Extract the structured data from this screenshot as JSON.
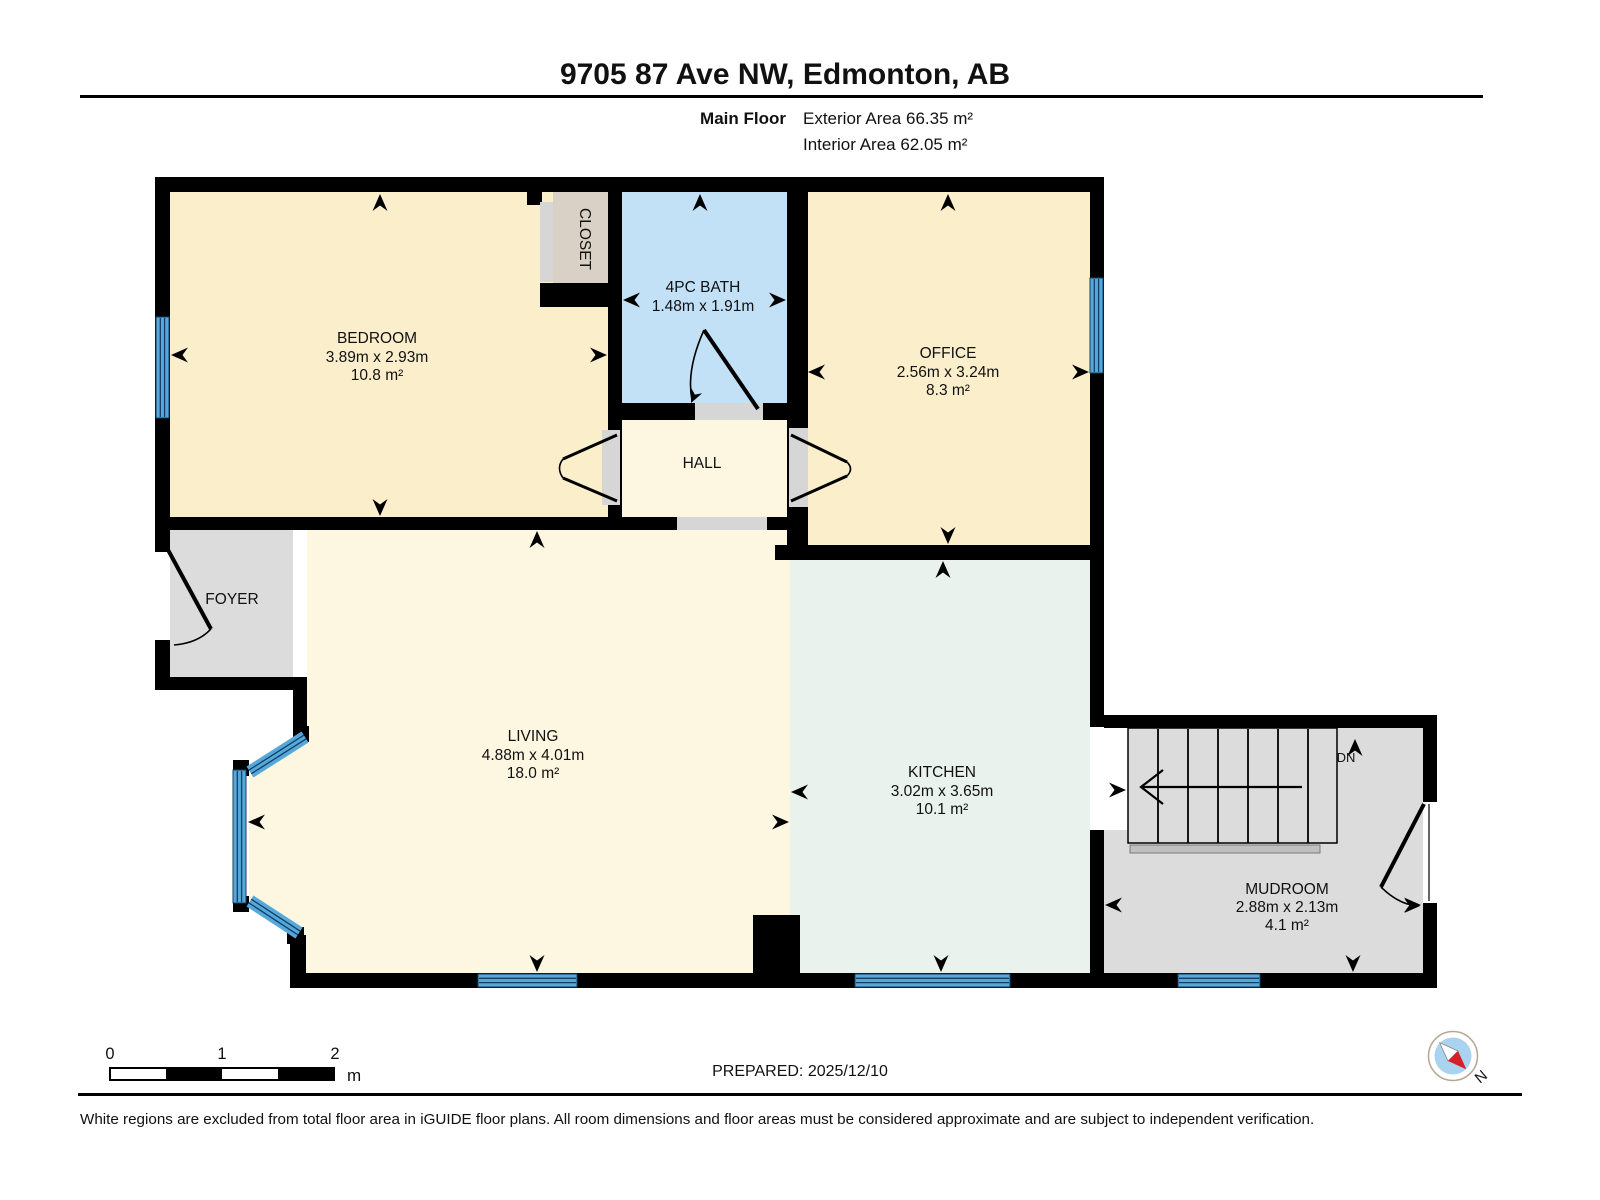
{
  "header": {
    "title": "9705 87 Ave NW, Edmonton, AB",
    "floor_label": "Main Floor",
    "exterior_area": "Exterior Area 66.35 m²",
    "interior_area": "Interior Area 62.05 m²"
  },
  "rooms": {
    "bedroom": {
      "name": "BEDROOM",
      "dims": "3.89m x 2.93m",
      "area": "10.8 m²"
    },
    "closet": {
      "name": "CLOSET"
    },
    "bath": {
      "name": "4PC BATH",
      "dims": "1.48m x 1.91m"
    },
    "office": {
      "name": "OFFICE",
      "dims": "2.56m x 3.24m",
      "area": "8.3 m²"
    },
    "hall": {
      "name": "HALL"
    },
    "foyer": {
      "name": "FOYER"
    },
    "living": {
      "name": "LIVING",
      "dims": "4.88m x 4.01m",
      "area": "18.0 m²"
    },
    "kitchen": {
      "name": "KITCHEN",
      "dims": "3.02m x 3.65m",
      "area": "10.1 m²"
    },
    "mudroom": {
      "name": "MUDROOM",
      "dims": "2.88m x 2.13m",
      "area": "4.1 m²"
    },
    "stairs": {
      "label": "DN"
    }
  },
  "scale_bar": {
    "ticks": [
      "0",
      "1",
      "2"
    ],
    "unit": "m"
  },
  "compass": {
    "label": "N"
  },
  "footer": {
    "prepared": "PREPARED: 2025/12/10",
    "disclaimer": "White regions are excluded from total floor area in iGUIDE floor plans. All room dimensions and floor areas must be considered approximate and are subject to independent verification."
  },
  "colors": {
    "wall": "#000000",
    "room_warm": "#fbeecb",
    "room_light": "#fdf6e0",
    "bath_blue": "#c2e0f6",
    "kitchen_mint": "#e9f2ec",
    "gray_room": "#dcdcdc",
    "closet_tan": "#d9d1c5",
    "window_blue": "#56a8da",
    "window_dark": "#123f66",
    "compass_red": "#d42127",
    "compass_blue": "#a9d3ee"
  }
}
